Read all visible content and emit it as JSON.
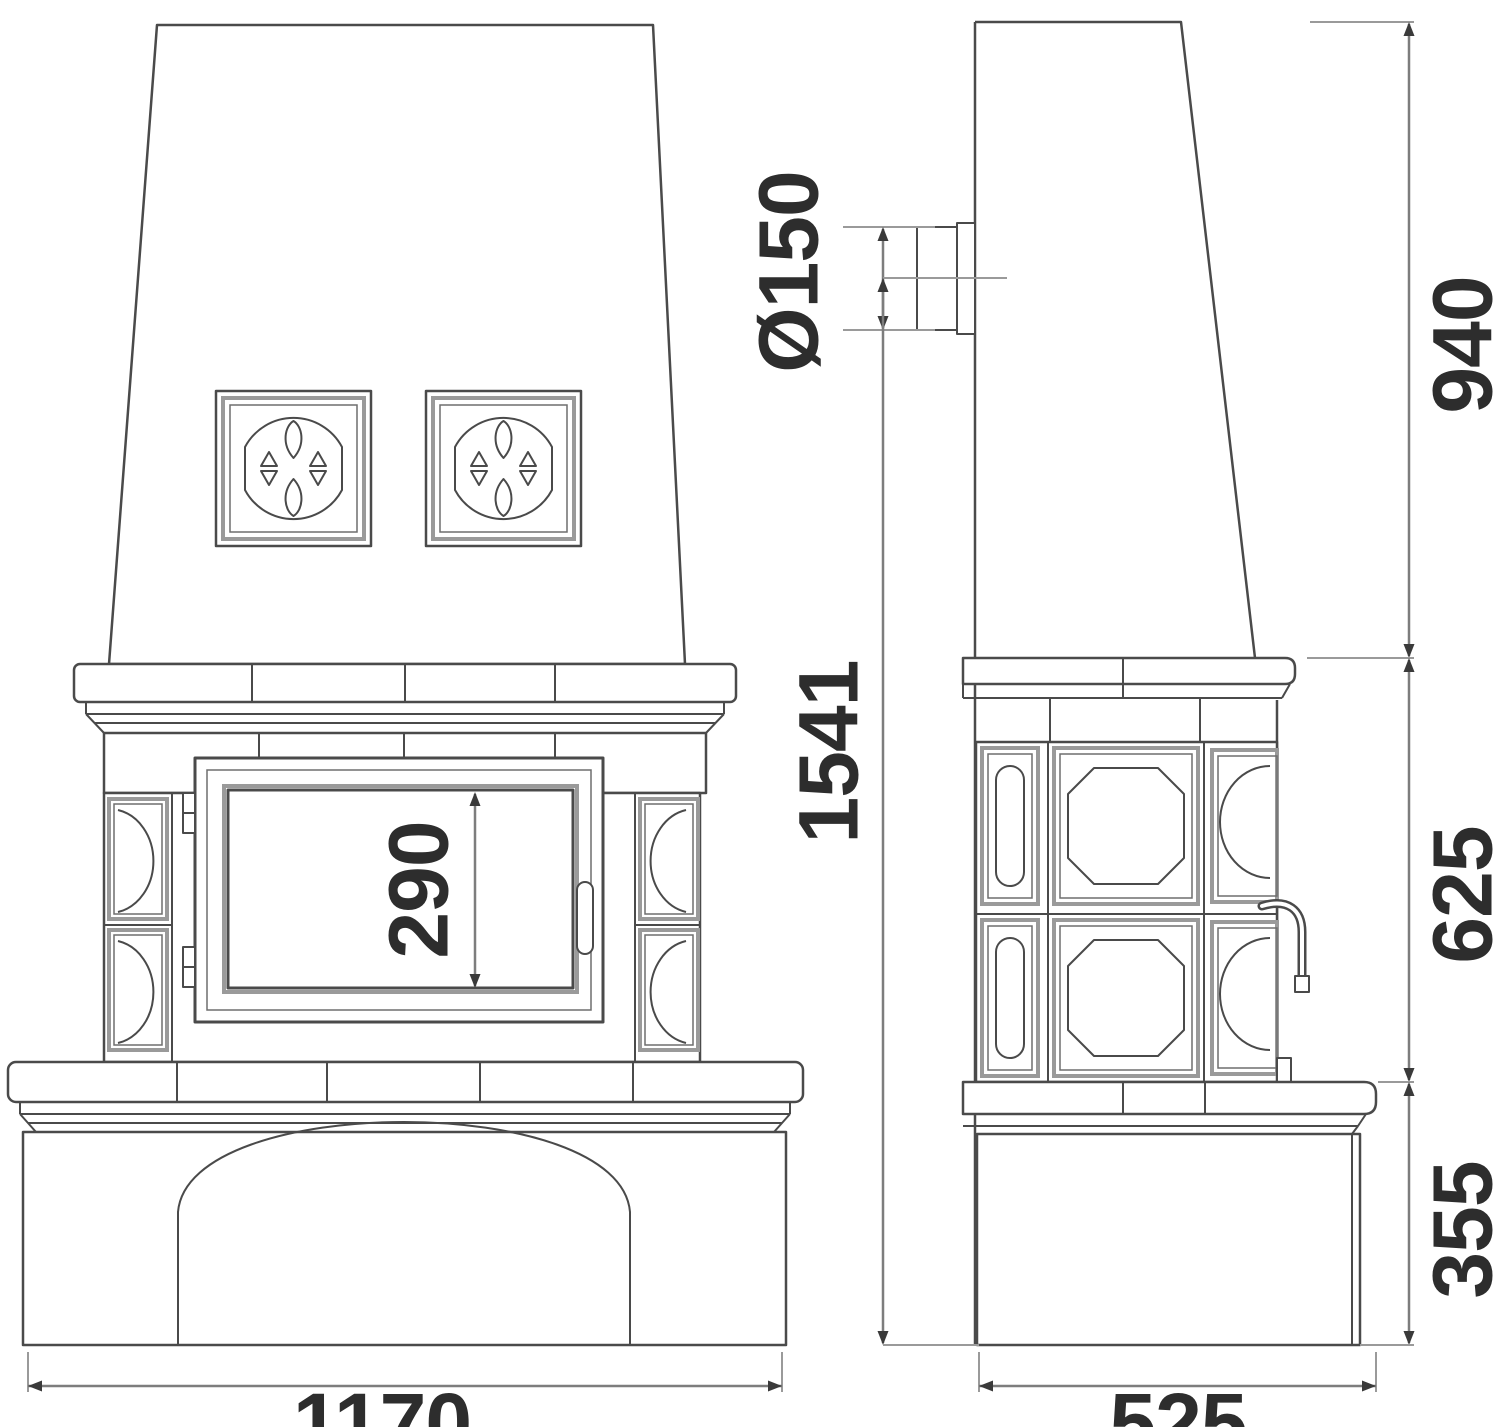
{
  "dimensions": {
    "flue_diameter": "Ø150",
    "height_upper": "940",
    "height_total": "1541",
    "door_opening_height": "290",
    "height_middle": "625",
    "height_base": "355",
    "width_front": "1170",
    "depth_side": "525"
  },
  "colors": {
    "line": "#4a4a4a",
    "line_light": "#9a9a9a",
    "dimension_line": "#7d7d7d",
    "text": "#2d2d2d",
    "background": "#ffffff"
  }
}
